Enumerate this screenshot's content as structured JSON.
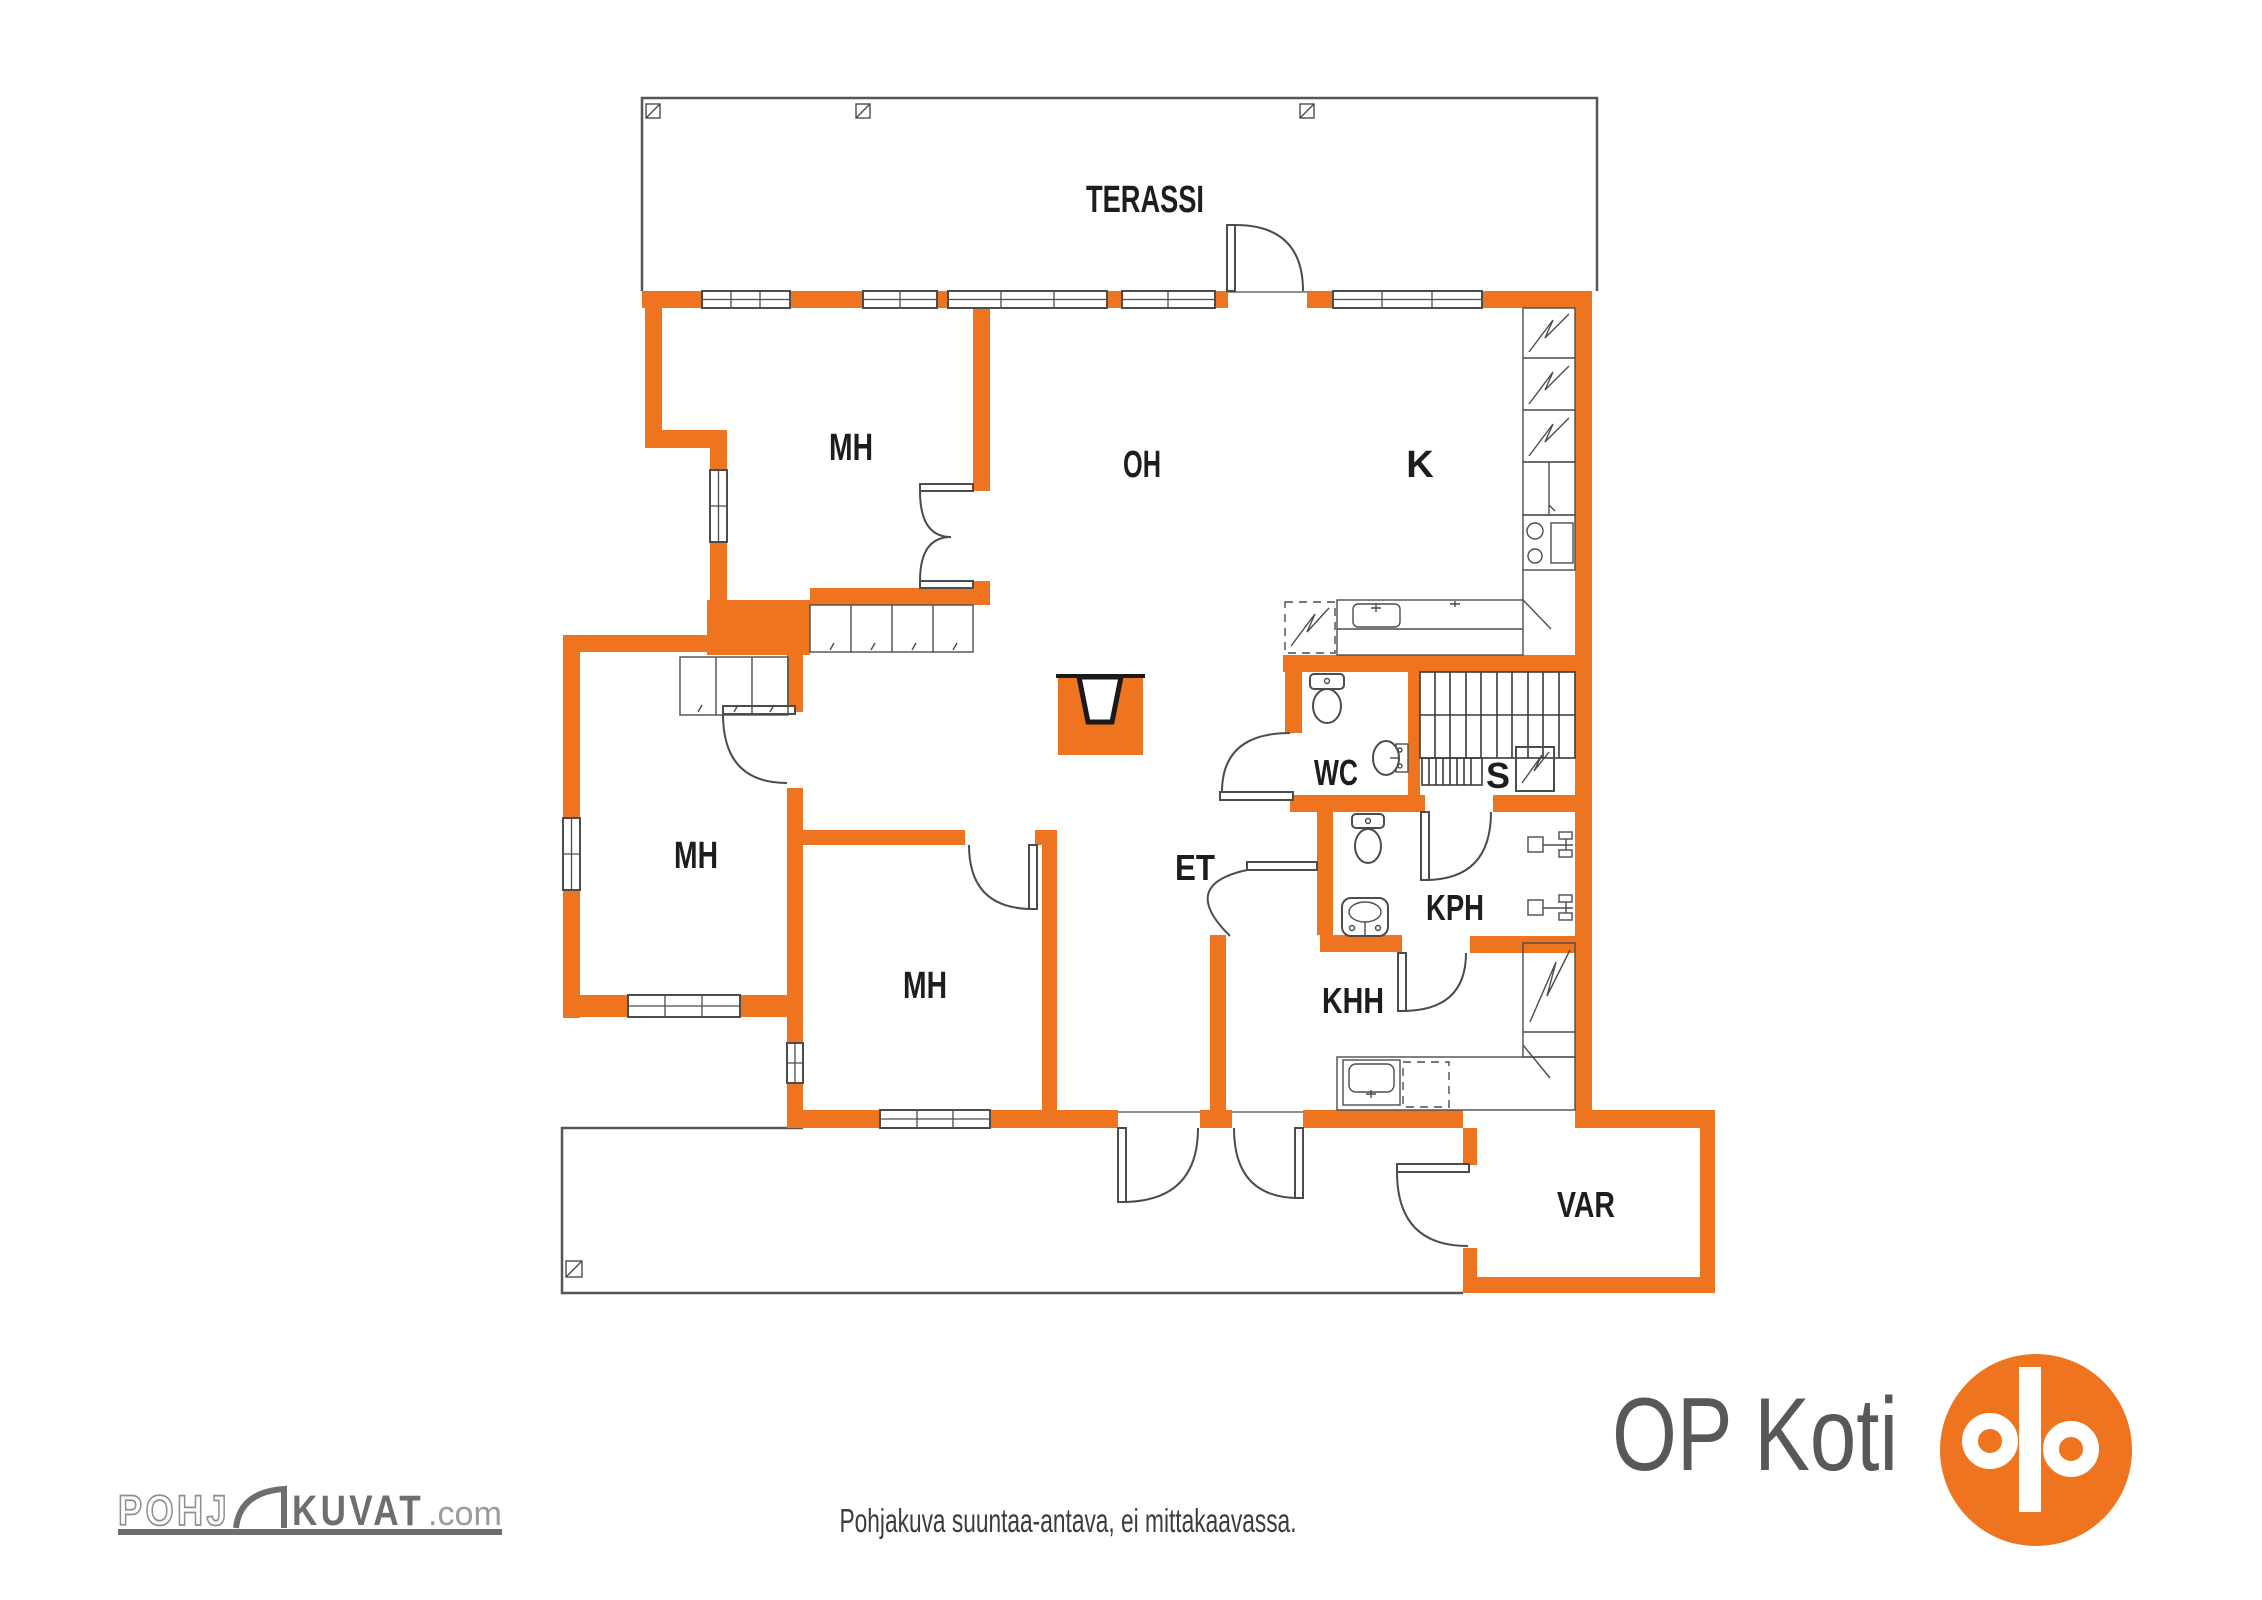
{
  "title": "Floor plan",
  "colors": {
    "accent_orange": "#EE7420",
    "plan_line_gray": "#4C4C4C",
    "outline_gray": "#55565A",
    "label_black": "#1D1D1B",
    "logo_gray": "#6E6E6E",
    "opkoti_text_gray": "#57585A"
  },
  "rooms": {
    "terassi": "TERASSI",
    "mh_upper": "MH",
    "oh": "OH",
    "k": "K",
    "mh_left": "MH",
    "mh_mid": "MH",
    "wc": "WC",
    "s": "S",
    "et": "ET",
    "kph": "KPH",
    "khh": "KHH",
    "var": "VAR"
  },
  "footer": {
    "disclaimer": "Pohjakuva suuntaa-antava, ei mittakaavassa.",
    "pohjakuvat_logo": {
      "part1": "POHJ",
      "part2": "KUVAT",
      "suffix": ".com"
    },
    "opkoti_text": "OP Koti"
  },
  "icons": [
    "terrace-post-icon",
    "window",
    "door-arc",
    "fireplace-icon",
    "stairs",
    "sauna-stove-icon",
    "fridge-freezer-icon",
    "stove-icon",
    "oven-icon",
    "sink-icon",
    "toilet-icon",
    "dishwasher-icon",
    "washer-icon",
    "shower-mixer-icon",
    "wardrobe",
    "door-glyph-icon",
    "op-logo-icon"
  ]
}
